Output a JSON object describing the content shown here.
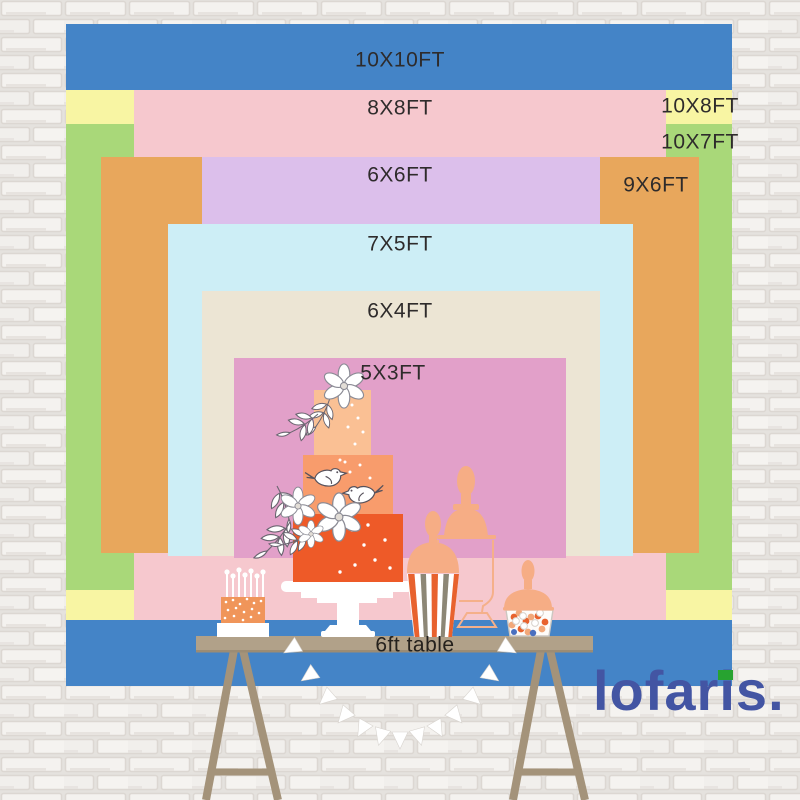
{
  "backdrop_sizes": {
    "s10x10": {
      "label": "10X10FT",
      "color": "#4484c7"
    },
    "s8x8": {
      "label": "8X8FT",
      "color": "#f6c8ce"
    },
    "s10x8": {
      "label": "10X8FT",
      "color": "#f8f5a3"
    },
    "s10x7": {
      "label": "10X7FT",
      "color": "#a9d879"
    },
    "s6x6": {
      "label": "6X6FT",
      "color": "#dcbfeb"
    },
    "s9x6": {
      "label": "9X6FT",
      "color": "#e8a75c"
    },
    "s7x5": {
      "label": "7X5FT",
      "color": "#cdeef6"
    },
    "s6x4": {
      "label": "6X4FT",
      "color": "#ece5d4"
    },
    "s5x3": {
      "label": "5X3FT",
      "color": "#e2a0c9"
    }
  },
  "table": {
    "label": "6ft table",
    "top_color": "#b1a189",
    "leg_color": "#a4937a"
  },
  "brand": {
    "name": "lofaris",
    "part1": "lofar",
    "part2": "i",
    "part3": "s",
    "period": ".",
    "text_color": "#4355a3",
    "accent_color": "#27a330"
  },
  "label_text_color": "#2e2b2b",
  "wall_color": "#f2f0ee"
}
